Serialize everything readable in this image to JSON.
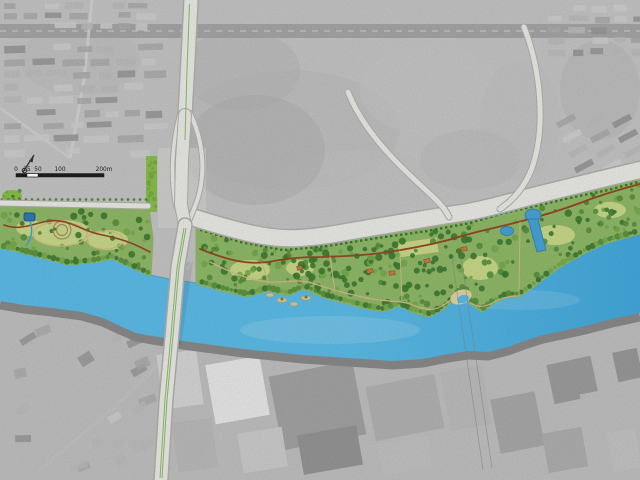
{
  "map": {
    "kind": "waterfront-park-master-plan-on-aerial-photo",
    "scale_bar": {
      "labels": [
        "0",
        "25",
        "50",
        "100",
        "200m"
      ]
    }
  },
  "colors": {
    "river": "#5fc2ef",
    "river_deep": "#46aee3",
    "pond": "#2f7fc0",
    "park": "#94bf6b",
    "lawn": "#cfe08d",
    "tree_dark": "#3f7c33",
    "tree_mid": "#59943f",
    "tree_light": "#7ab04f",
    "verge_green": "#8ec64a",
    "path_red": "#9a4a26",
    "path_tan": "#d8c08f",
    "road_fill": "#f1f1ed",
    "road_edge": "#b7b7b1",
    "aerial_base": "#cbcbcb",
    "aerial_south": "#c6c6c6",
    "quay": "#8e8e8e",
    "roof": "#d08040",
    "beach": "#e9d9a6",
    "scalebar_ink": "#1c1c1c"
  }
}
